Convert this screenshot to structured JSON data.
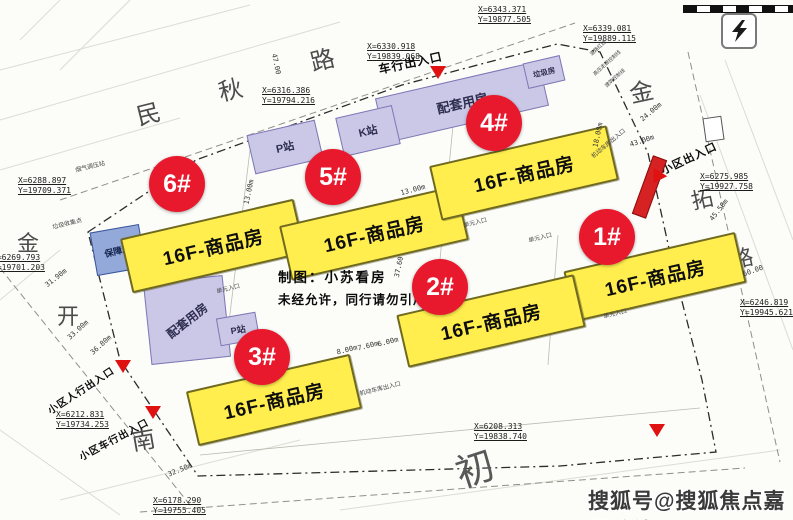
{
  "watermark": "搜狐号@搜狐焦点嘉峪关站",
  "credit": {
    "line1": "制图：小苏看房",
    "line2": "未经允许，同行请勿引用"
  },
  "buildings": {
    "b1": {
      "badge": "1#",
      "label": "16F-商品房"
    },
    "b2": {
      "badge": "2#",
      "label": "16F-商品房"
    },
    "b3": {
      "badge": "3#",
      "label": "16F-商品房"
    },
    "b4": {
      "badge": "4#",
      "label": "16F-商品房"
    },
    "b5": {
      "badge": "5#",
      "label": "16F-商品房"
    },
    "b6": {
      "badge": "6#",
      "label": "16F-商品房"
    },
    "support_top": {
      "label": "配套用房"
    },
    "support_bottom": {
      "label": "配套用房"
    },
    "k_station": {
      "label": "K站"
    },
    "p_station_top": {
      "label": "P站"
    },
    "p_station_bottom": {
      "label": "P站"
    },
    "garbage_room": {
      "label": "垃圾房"
    },
    "welfare": {
      "label": "保障房"
    }
  },
  "entrances": {
    "vehicle_top": "车行出入口",
    "community_right": "小区出入口",
    "pedestrian_bottom_left": "小区人行出入口",
    "vehicle_bottom_left": "小区车行出入口"
  },
  "roads": {
    "minqiu": [
      "民",
      "秋",
      "路"
    ],
    "jintuo": [
      "金",
      "拓",
      "路"
    ],
    "west": [
      "金",
      "开",
      "南"
    ],
    "south": [
      "初"
    ]
  },
  "coordinates": [
    {
      "x": "X=6343.371",
      "y": "Y=19877.505"
    },
    {
      "x": "X=6330.918",
      "y": "Y=19839.068"
    },
    {
      "x": "X=6339.081",
      "y": "Y=19889.115"
    },
    {
      "x": "X=6316.386",
      "y": "Y=19794.216"
    },
    {
      "x": "X=6288.897",
      "y": "Y=19709.371"
    },
    {
      "x": "X=6269.793",
      "y": "Y=19701.203"
    },
    {
      "x": "X=6275.985",
      "y": "Y=19927.758"
    },
    {
      "x": "X=6246.819",
      "y": "Y=19945.621"
    },
    {
      "x": "X=6208.313",
      "y": "Y=19838.740"
    },
    {
      "x": "X=6212.831",
      "y": "Y=19734.253"
    },
    {
      "x": "X=6178.290",
      "y": "Y=19755.405"
    }
  ],
  "dims": [
    "47.00",
    "13.00m",
    "13.00m",
    "18.00m",
    "37.60",
    "8.00m",
    "7.60m",
    "6.00m",
    "24.00m",
    "43.00m",
    "45.50m",
    "60.00",
    "31.90m",
    "33.00m",
    "36.80m",
    "32.50m"
  ],
  "small_labels": [
    "烟气调压站",
    "垃圾收集点",
    "机动车库出入口",
    "机动车库出入口",
    "单元入口",
    "单元入口",
    "单元入口",
    "单元入口",
    "道路红线",
    "高压走廊控制线",
    "建筑控制线"
  ],
  "colors": {
    "building_yellow": "#ffee4d",
    "support_purple": "#cbc7e6",
    "welfare_blue": "#93a9da",
    "badge_red": "#e8192d",
    "marker_red": "#e01111"
  }
}
